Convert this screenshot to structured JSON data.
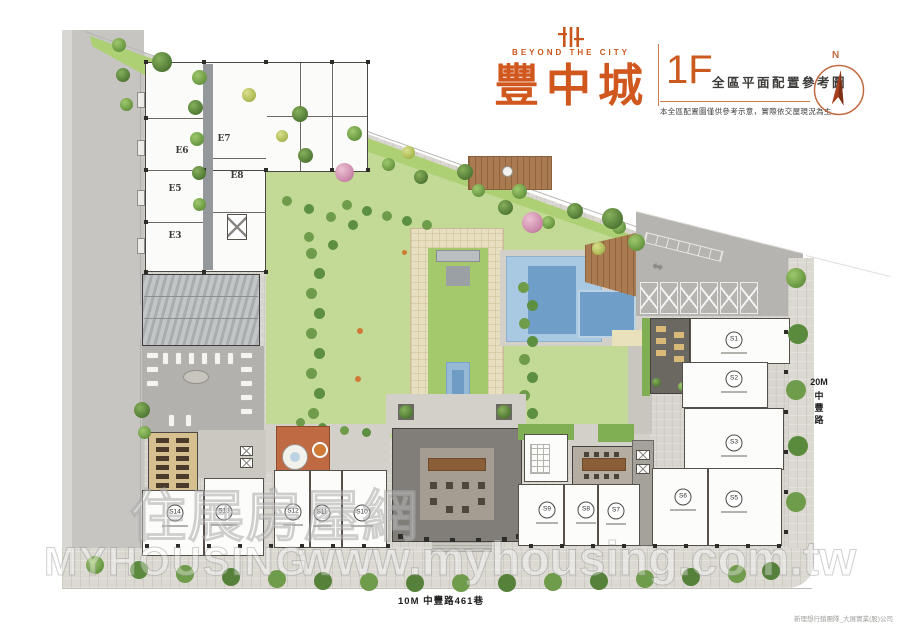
{
  "header": {
    "brand_tagline": "BEYOND THE CITY",
    "project_name": "豐中城",
    "floor_label": "1F",
    "plan_title": "全區平面配置參考圖",
    "disclaimer": "本全區配置圖僅供參考示意，實際依交屋現況為主",
    "compass_label": "N",
    "accent_color": "#c8551c"
  },
  "roads": {
    "right_width": "20M",
    "right_name": "中豐路",
    "bottom_label": "10M 中豐路461巷"
  },
  "units": {
    "residential": [
      "E6",
      "E7",
      "E8",
      "E5",
      "E3"
    ],
    "shops": [
      "S1",
      "S2",
      "S3",
      "S5",
      "S6",
      "S7",
      "S8",
      "S9",
      "S10",
      "S11",
      "S12",
      "S13",
      "S14"
    ]
  },
  "watermark": {
    "logo_cn": "住展房屋網",
    "logo_en": "MYHOUSING",
    "url": "www.myhousing.com.tw"
  },
  "credit": "新理想行銷團隊_大展實業(股)公司"
}
